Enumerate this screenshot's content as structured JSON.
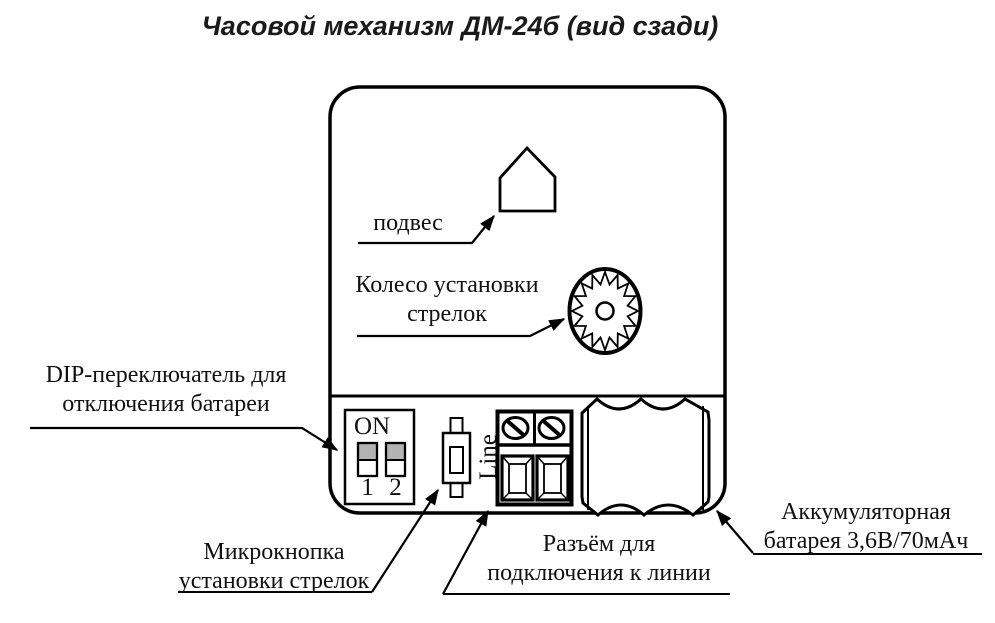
{
  "title": "Часовой механизм ДМ-24б (вид сзади)",
  "labels": {
    "hanger": "подвес",
    "wheel": {
      "line1": "Колесо установки",
      "line2": "стрелок"
    },
    "dip": {
      "line1": "DIP-переключатель для",
      "line2": "отключения батареи"
    },
    "microbutton": {
      "line1": "Микрокнопка",
      "line2": "установки стрелок"
    },
    "connector": {
      "line1": "Разъём для",
      "line2": "подключения к линии"
    },
    "battery": {
      "line1": "Аккумуляторная",
      "line2": "батарея 3,6В/70мАч"
    }
  },
  "device": {
    "dip_switch": {
      "on_label": "ON",
      "switch1_label": "1",
      "switch2_label": "2"
    },
    "terminal": {
      "line_label": "Line"
    }
  },
  "components": [
    "device-body-rear-view",
    "hanger-pentagon-icon",
    "hands-setting-wheel-icon",
    "dip-switch-icon",
    "microbutton-icon",
    "line-terminal-block-icon",
    "battery-icon"
  ],
  "colors": {
    "ink": "#000000",
    "background": "#ffffff",
    "dip_switch_fill": "#b3b3b3"
  }
}
